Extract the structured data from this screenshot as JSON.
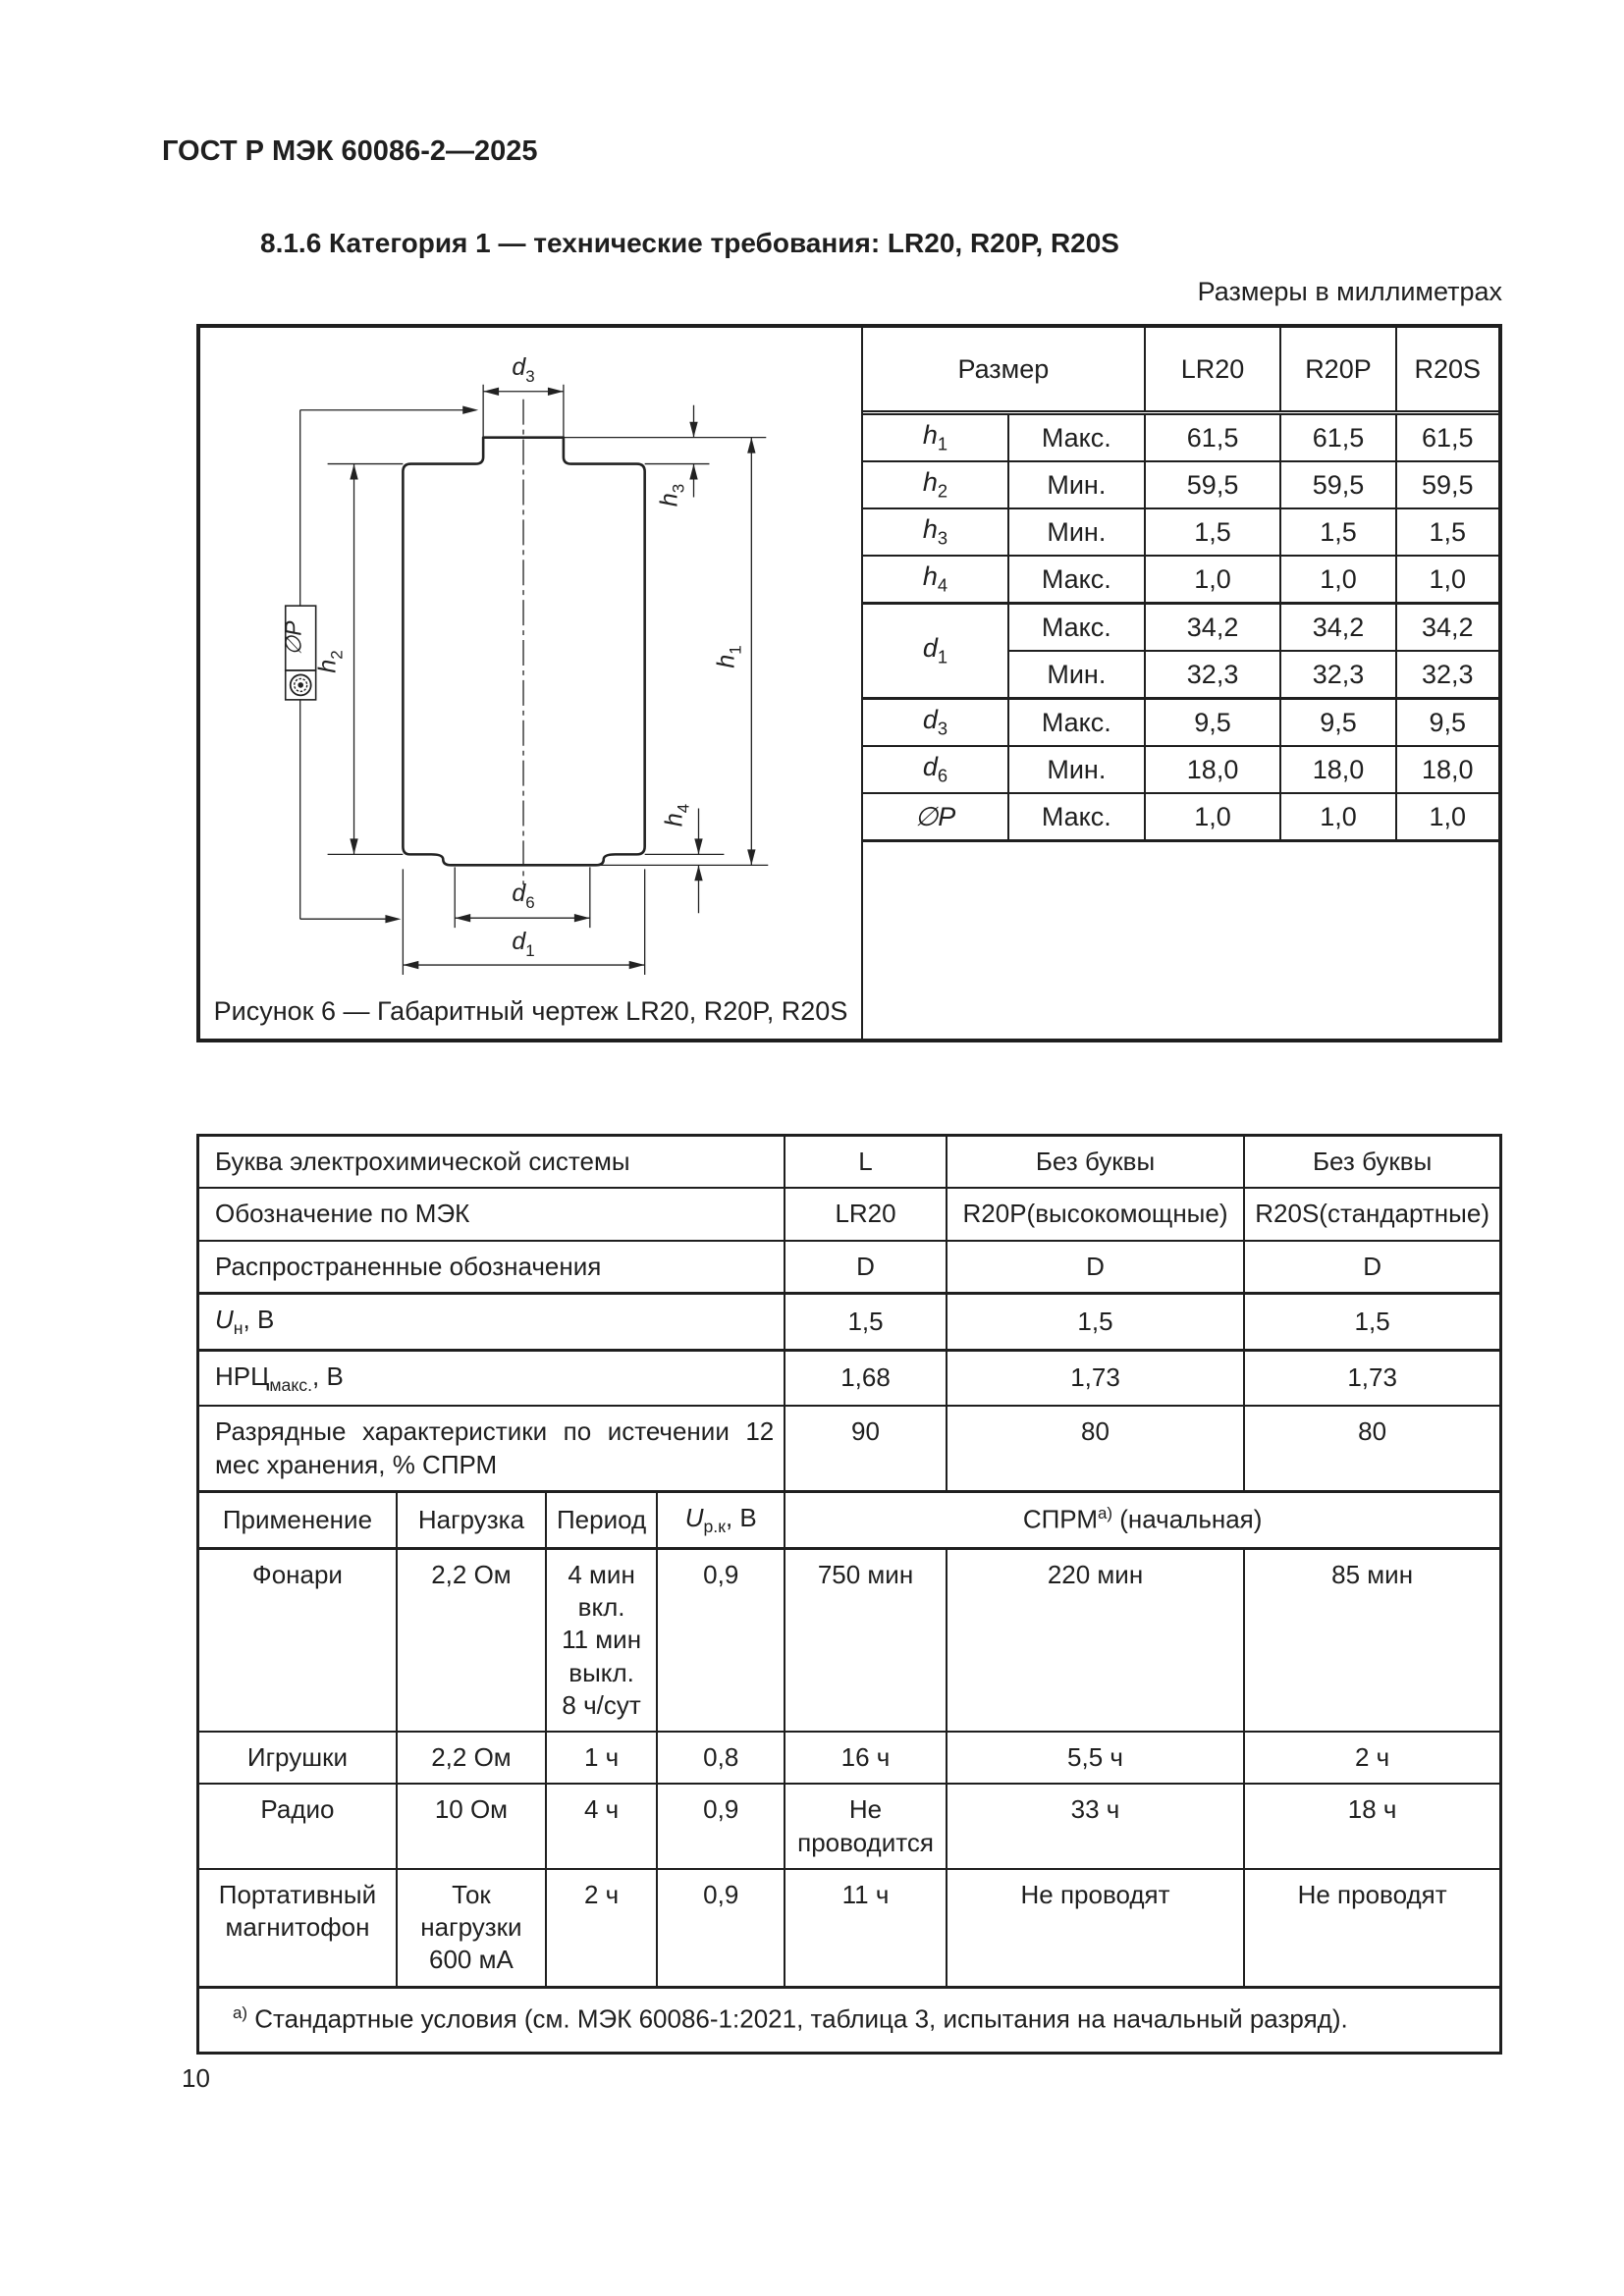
{
  "page": {
    "header": "ГОСТ Р МЭК 60086-2—2025",
    "section_heading": "8.1.6 Категория 1 — технические требования: LR20, R20P, R20S",
    "units_note": "Размеры в миллиметрах",
    "page_number": "10"
  },
  "figure": {
    "caption": "Рисунок 6 — Габаритный чертеж LR20, R20P, R20S",
    "labels": {
      "d3": {
        "m": "d",
        "s": "3"
      },
      "h3": {
        "m": "h",
        "s": "3"
      },
      "h1": {
        "m": "h",
        "s": "1"
      },
      "h2": {
        "m": "h",
        "s": "2"
      },
      "h4": {
        "m": "h",
        "s": "4"
      },
      "d6": {
        "m": "d",
        "s": "6"
      },
      "d1": {
        "m": "d",
        "s": "1"
      },
      "phi_p": "∅P"
    }
  },
  "dims_table": {
    "size_header": "Размер",
    "col_headers": [
      "LR20",
      "R20P",
      "R20S"
    ],
    "rows": [
      {
        "sym": "h",
        "sub": "1",
        "limit": "Макс.",
        "values": [
          "61,5",
          "61,5",
          "61,5"
        ]
      },
      {
        "sym": "h",
        "sub": "2",
        "limit": "Мин.",
        "values": [
          "59,5",
          "59,5",
          "59,5"
        ]
      },
      {
        "sym": "h",
        "sub": "3",
        "limit": "Мин.",
        "values": [
          "1,5",
          "1,5",
          "1,5"
        ]
      },
      {
        "sym": "h",
        "sub": "4",
        "limit": "Макс.",
        "values": [
          "1,0",
          "1,0",
          "1,0"
        ]
      },
      {
        "sym": "d",
        "sub": "1",
        "limit": "Макс.",
        "values": [
          "34,2",
          "34,2",
          "34,2"
        ]
      },
      {
        "sym": "",
        "sub": "",
        "limit": "Мин.",
        "values": [
          "32,3",
          "32,3",
          "32,3"
        ]
      },
      {
        "sym": "d",
        "sub": "3",
        "limit": "Макс.",
        "values": [
          "9,5",
          "9,5",
          "9,5"
        ]
      },
      {
        "sym": "d",
        "sub": "6",
        "limit": "Мин.",
        "values": [
          "18,0",
          "18,0",
          "18,0"
        ]
      },
      {
        "sym": "∅P",
        "sub": "",
        "limit": "Макс.",
        "values": [
          "1,0",
          "1,0",
          "1,0"
        ]
      }
    ]
  },
  "spec_table": {
    "rows": [
      {
        "label": "Буква электрохимической системы",
        "values": [
          "L",
          "Без буквы",
          "Без буквы"
        ]
      },
      {
        "label": "Обозначение по МЭК",
        "values": [
          "LR20",
          "R20P(высокомощные)",
          "R20S(стандартные)"
        ]
      },
      {
        "label": "Распространенные обозначения",
        "values": [
          "D",
          "D",
          "D"
        ]
      },
      {
        "label_main": "U",
        "label_sub": "н",
        "label_suffix": ", В",
        "values": [
          "1,5",
          "1,5",
          "1,5"
        ]
      },
      {
        "label_main": "НРЦ",
        "label_sub": "макс.",
        "label_suffix": ", В",
        "values": [
          "1,68",
          "1,73",
          "1,73"
        ]
      },
      {
        "label": "Разрядные характеристики по истечении 12 мес хранения, % СПРМ",
        "values": [
          "90",
          "80",
          "80"
        ]
      }
    ],
    "app_header": {
      "application": "Применение",
      "load": "Нагрузка",
      "period": "Период",
      "u_main": "U",
      "u_sub": "р.к",
      "u_suffix": ", В",
      "sprm_main": "СПРМ",
      "sprm_sup": "а)",
      "sprm_suffix": " (начальная)"
    },
    "app_rows": [
      {
        "application": "Фонари",
        "load": "2,2 Ом",
        "period": "4 мин\nвкл.\n11 мин\nвыкл.\n8 ч/сут",
        "voltage": "0,9",
        "values": [
          "750 мин",
          "220 мин",
          "85 мин"
        ]
      },
      {
        "application": "Игрушки",
        "load": "2,2 Ом",
        "period": "1 ч",
        "voltage": "0,8",
        "values": [
          "16 ч",
          "5,5 ч",
          "2 ч"
        ]
      },
      {
        "application": "Радио",
        "load": "10 Ом",
        "period": "4 ч",
        "voltage": "0,9",
        "values": [
          "Не проводится",
          "33 ч",
          "18 ч"
        ]
      },
      {
        "application": "Портативный магнитофон",
        "load": "Ток нагрузки 600 мА",
        "period": "2 ч",
        "voltage": "0,9",
        "values": [
          "11 ч",
          "Не проводят",
          "Не проводят"
        ]
      }
    ],
    "footnote_sup": "а)",
    "footnote_text": " Стандартные условия (см. МЭК 60086-1:2021, таблица 3, испытания на начальный разряд)."
  }
}
